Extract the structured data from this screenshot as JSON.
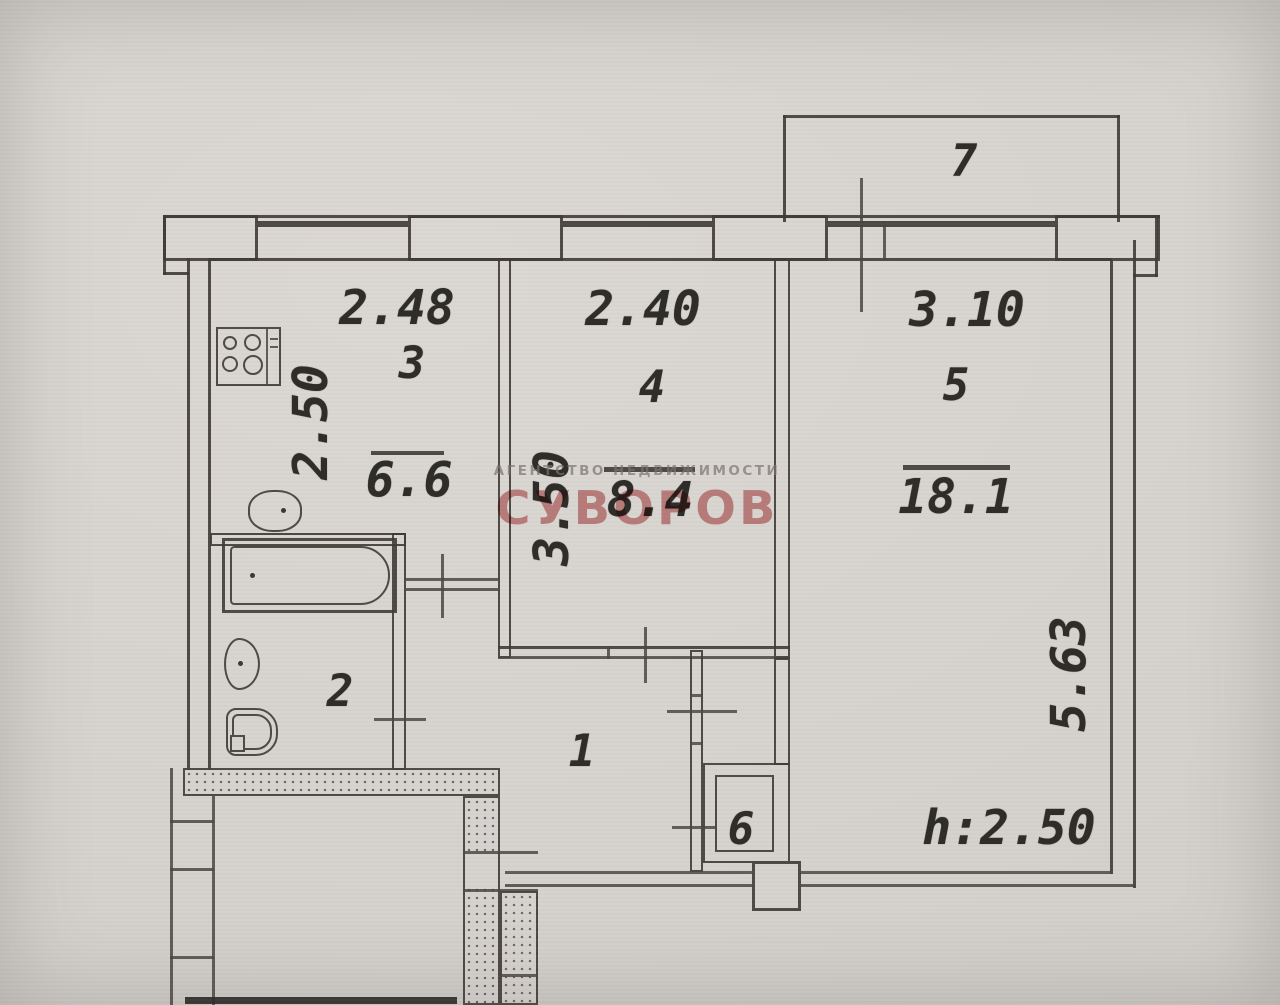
{
  "plan": {
    "watermark": {
      "agency_line": "АГЕНТСТВО НЕДВИЖИМОСТИ",
      "agency_name": "СУВОРОВ"
    },
    "ceiling_height": "h:2.50",
    "rooms": {
      "hall": {
        "number": "1"
      },
      "bathroom": {
        "number": "2"
      },
      "kitchen": {
        "number": "3",
        "width_m": "2.48",
        "depth_m": "2.50",
        "area": "6.6"
      },
      "room4": {
        "number": "4",
        "width_m": "2.40",
        "depth_m": "3.50",
        "area": "8.4"
      },
      "room5": {
        "number": "5",
        "width_m": "3.10",
        "depth_m": "5.63",
        "area": "18.1"
      },
      "closet": {
        "number": "6"
      },
      "balcony": {
        "number": "7"
      }
    },
    "colors": {
      "paper": "#d6d3cf",
      "ink": "#3e3a35",
      "watermark_red": "#bf5252",
      "watermark_gray": "#7a746b"
    },
    "fixtures": [
      "stove-icon",
      "kitchen-sink-icon",
      "bathtub-icon",
      "washbasin-icon",
      "toilet-icon"
    ]
  }
}
